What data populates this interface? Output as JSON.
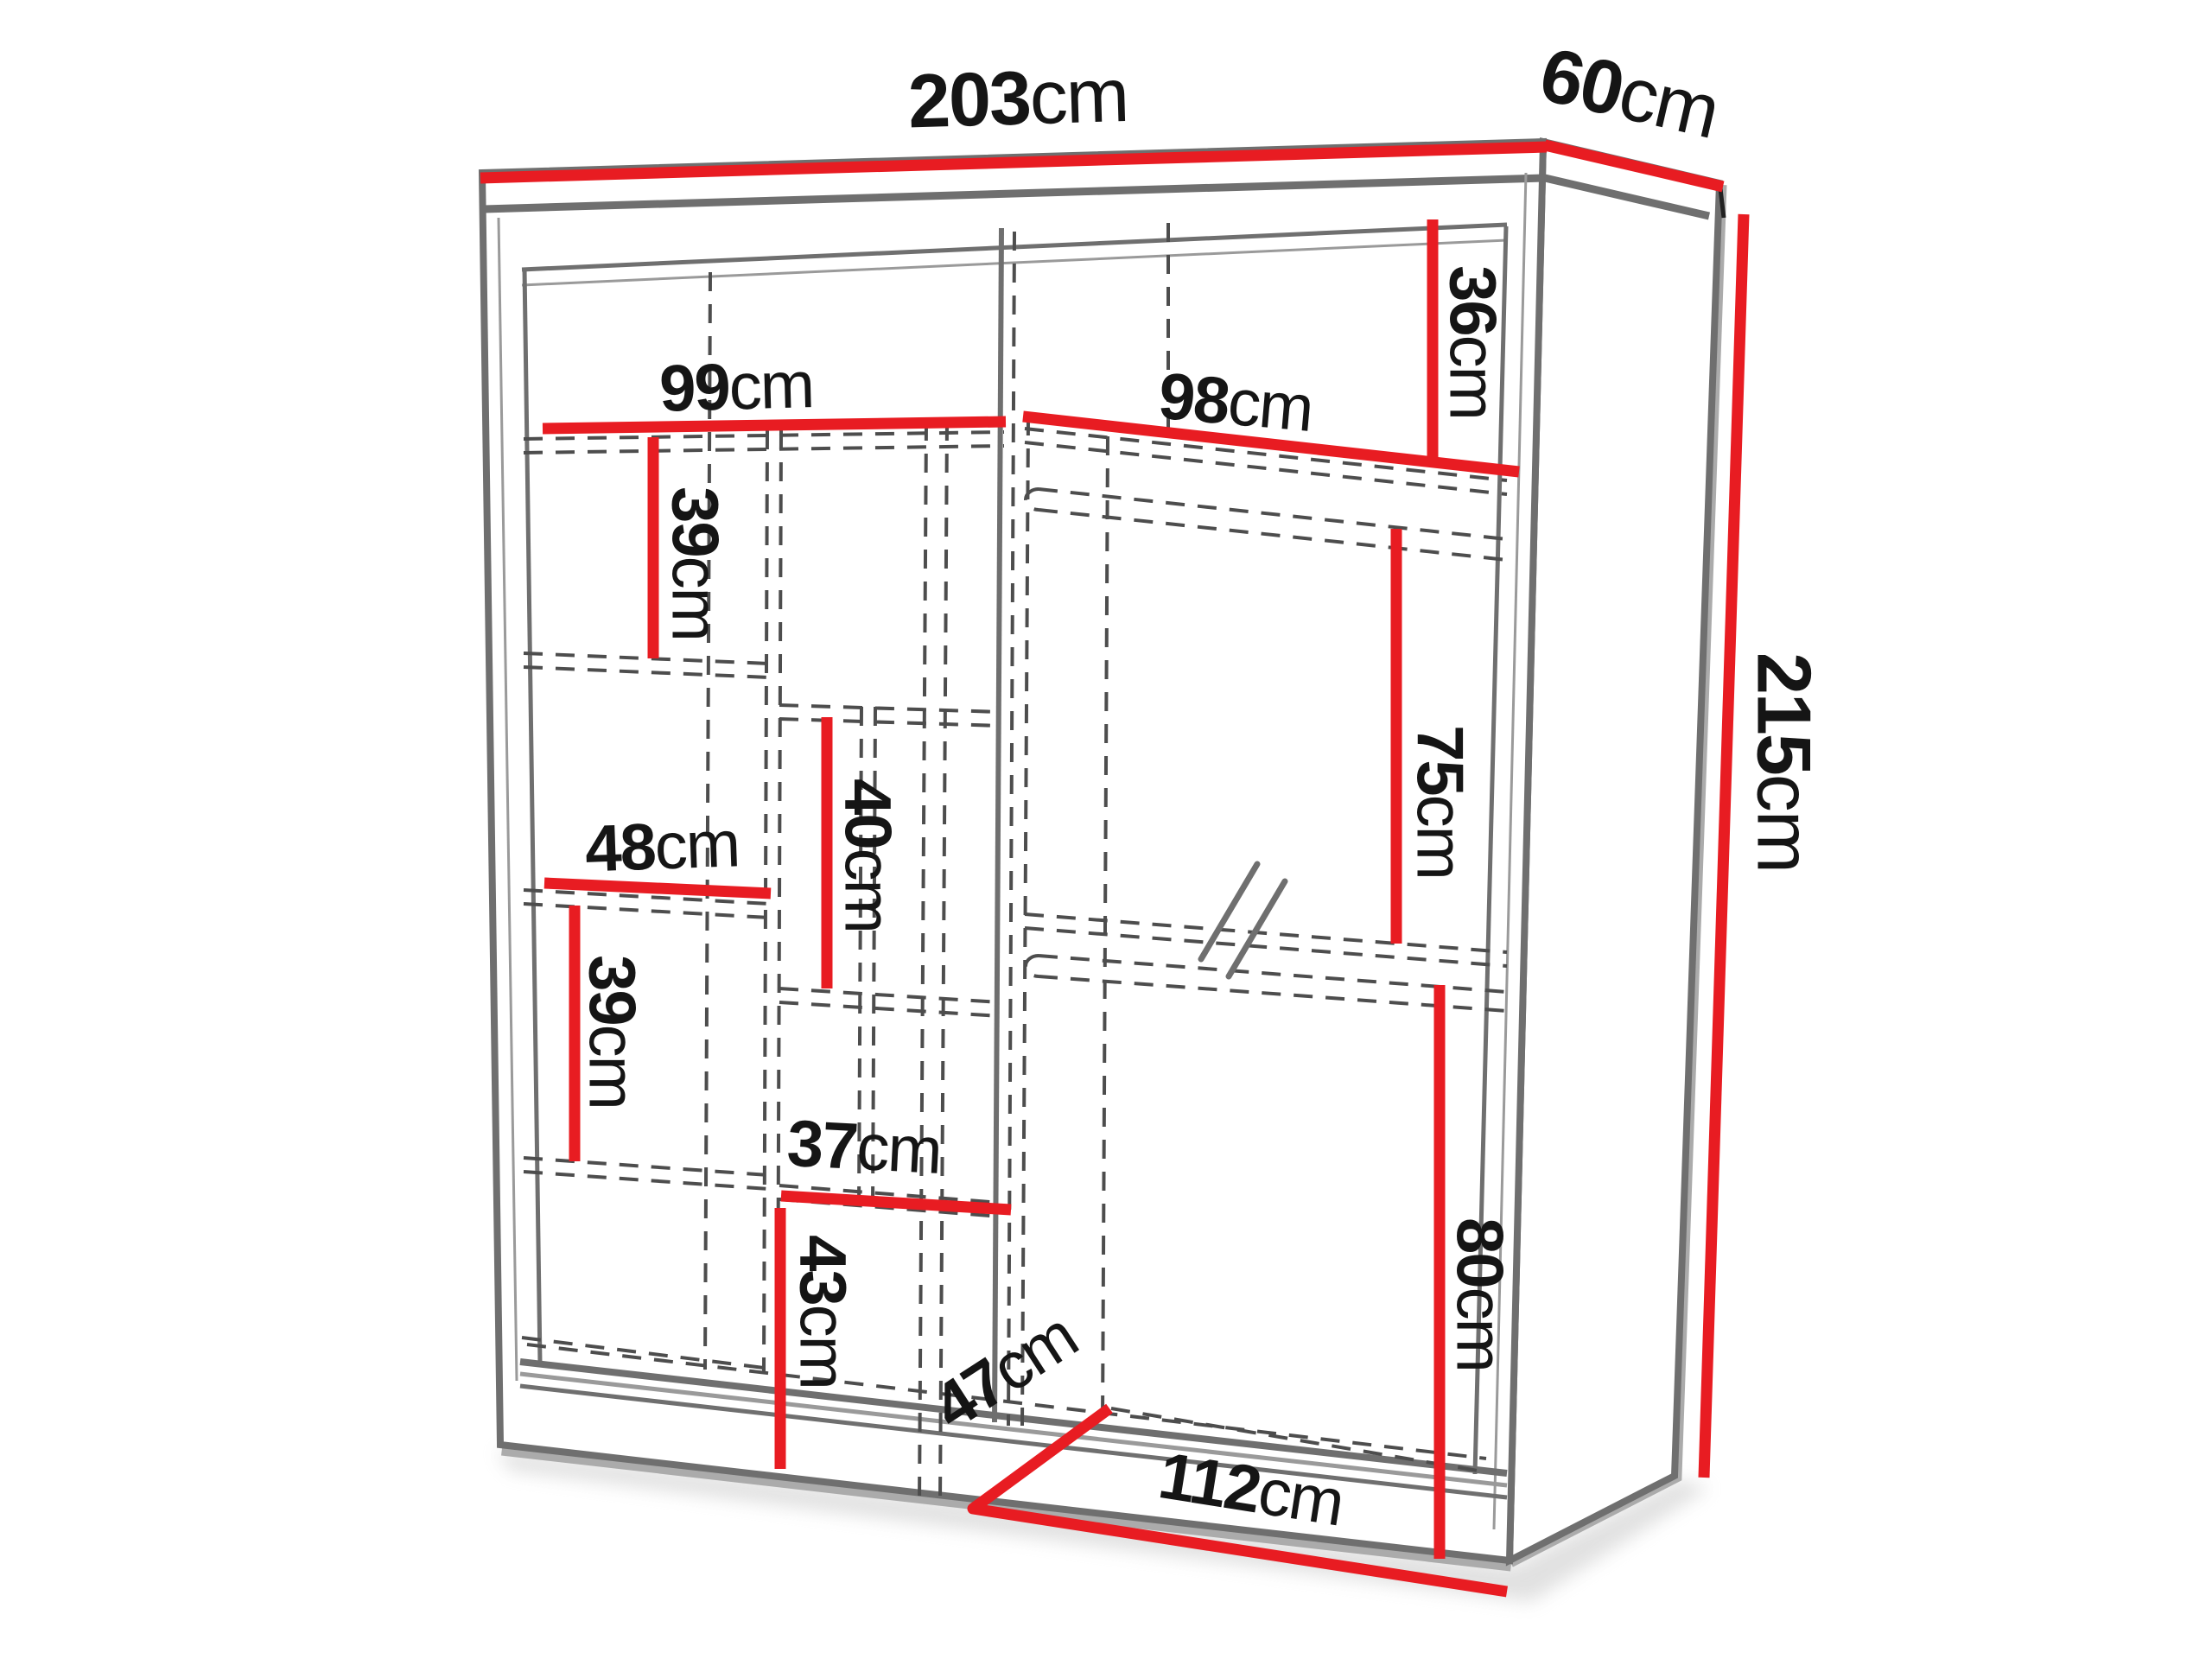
{
  "diagram": {
    "type": "furniture-dimension-diagram",
    "subject": "sliding-door wardrobe with interior shelving and hanging rails",
    "unit": "cm",
    "colors": {
      "dimension_line": "#e81c22",
      "structure_line": "#6f6f6f",
      "dashed_line": "#4d4d4d",
      "label_text": "#151515",
      "background": "#ffffff"
    },
    "overall_dimensions": {
      "width_cm": 203,
      "depth_cm": 60,
      "height_cm": 215
    },
    "labels": {
      "width": {
        "value": "203",
        "unit": "cm"
      },
      "depth": {
        "value": "60",
        "unit": "cm"
      },
      "height": {
        "value": "215",
        "unit": "cm"
      },
      "left_opening_width": {
        "value": "99",
        "unit": "cm"
      },
      "right_opening_width": {
        "value": "98",
        "unit": "cm"
      },
      "top_shelf_height": {
        "value": "36",
        "unit": "cm"
      },
      "upper_left_shelf_height": {
        "value": "39",
        "unit": "cm"
      },
      "middle_shelf_height": {
        "value": "40",
        "unit": "cm"
      },
      "left_column_width": {
        "value": "48",
        "unit": "cm"
      },
      "lower_left_shelf_height": {
        "value": "39",
        "unit": "cm"
      },
      "middle_column_width": {
        "value": "37",
        "unit": "cm"
      },
      "bottom_middle_height": {
        "value": "43",
        "unit": "cm"
      },
      "upper_hanging_height": {
        "value": "75",
        "unit": "cm"
      },
      "lower_hanging_height": {
        "value": "80",
        "unit": "cm"
      },
      "interior_depth": {
        "value": "47",
        "unit": "cm"
      },
      "bottom_opening_width": {
        "value": "112",
        "unit": "cm"
      }
    },
    "interior_measurements_cm": [
      99,
      98,
      36,
      39,
      40,
      48,
      39,
      37,
      43,
      75,
      80,
      47,
      112
    ]
  }
}
